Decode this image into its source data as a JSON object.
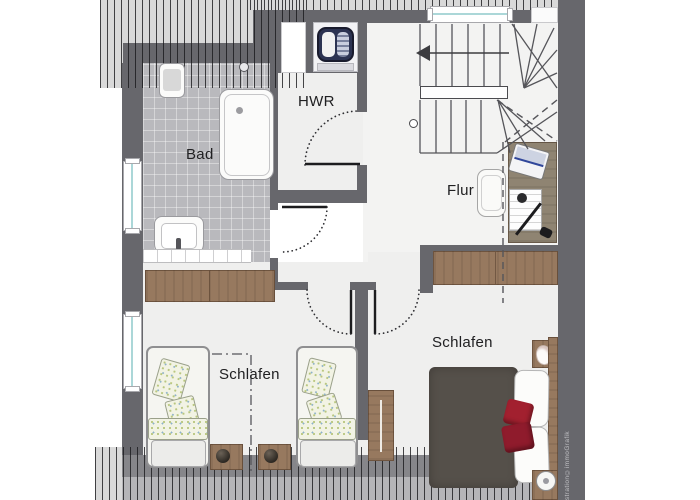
{
  "plan": {
    "kind": "floor-plan-top-view"
  },
  "rooms": {
    "bad": {
      "label": "Bad"
    },
    "hwr": {
      "label": "HWR"
    },
    "flur": {
      "label": "Flur"
    },
    "schlafen_left": {
      "label": "Schlafen"
    },
    "schlafen_right": {
      "label": "Schlafen"
    }
  },
  "watermark": {
    "text": "Illustration©immoGrafik"
  },
  "colors": {
    "wall": "#67676c",
    "tile_floor": "#b9b9bd",
    "room_floor": "#efefee",
    "hatch_background": "#d9d9d9",
    "wood": "#97795f",
    "duvet": "#55504a",
    "accent_pillow": "#a2202f",
    "window_glass": "#abd7d8",
    "washer_door": "#2c3352"
  },
  "icons": {
    "bathtub": "rounded-rect outline",
    "washbasin": "rounded-rect with basin",
    "washing-machine": "dark round-door drum",
    "staircase": "treads with up-arrow",
    "desk": "wood rect with laptop, papers, lamp",
    "office-chair": "white rounded seat",
    "wardrobe": "wood sideboard rect",
    "single-bed": "white bed with floral pillows",
    "double-bed": "dark duvet, white pillows, red cushions",
    "nightstand": "small wood square",
    "plant": "dark sphere",
    "bed-lamp": "white circle",
    "door-swing": "dotted quarter arc",
    "roof-slope-hatch": "vertical line hatching"
  }
}
